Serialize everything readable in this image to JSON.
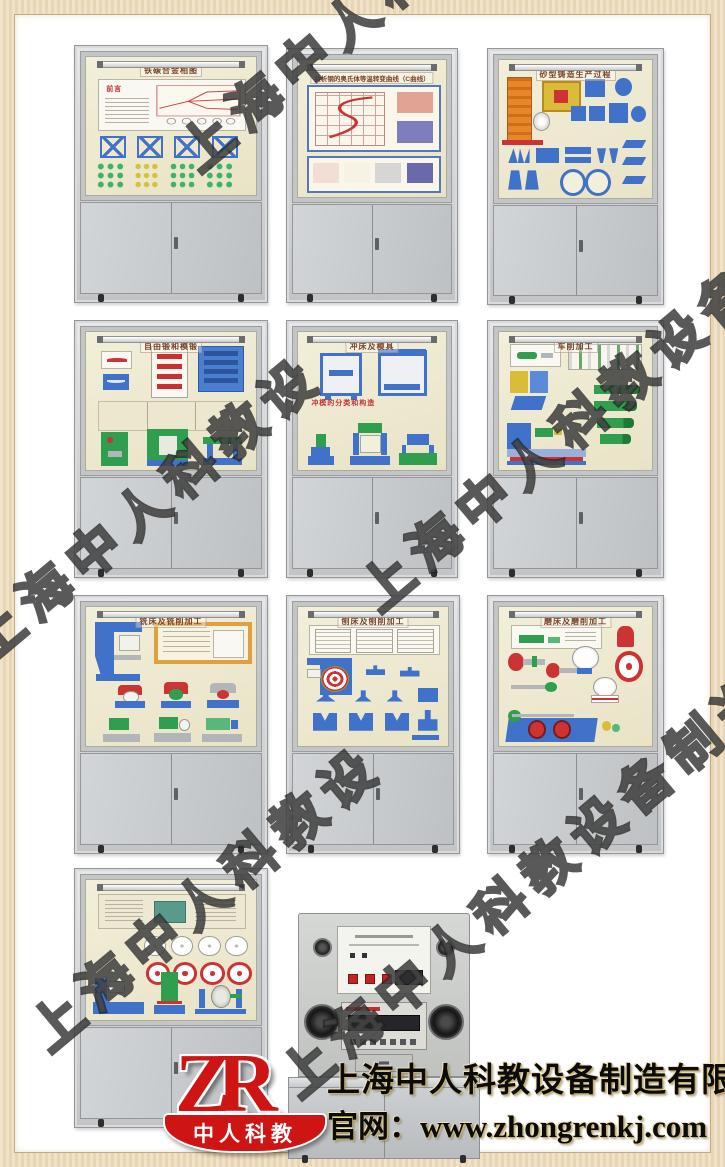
{
  "page": {
    "frame_color": "#e9d8b8",
    "background": "#ffffff",
    "description_colors": {
      "cabinet_gray": "#c6c9cc",
      "backboard_cream": "#efead2",
      "model_blue": "#3f72c8",
      "model_green": "#2f9e4f",
      "model_yellow": "#d9bc3a",
      "model_orange": "#e8872a",
      "model_red": "#cc3333"
    }
  },
  "watermark": {
    "text": "上海中人科教设备制造有限公司"
  },
  "cabinets": [
    {
      "id": 1,
      "title": "铁碳合金相图",
      "label": "前言"
    },
    {
      "id": 2,
      "title": "共析钢的奥氏体等温转变曲线（C曲线）",
      "label": ""
    },
    {
      "id": 3,
      "title": "砂型铸造生产过程",
      "label": ""
    },
    {
      "id": 4,
      "title": "自由锻和模锻",
      "label": ""
    },
    {
      "id": 5,
      "title": "冲床及模具",
      "label": "冲模的分类和构造"
    },
    {
      "id": 6,
      "title": "车削加工",
      "label": ""
    },
    {
      "id": 7,
      "title": "铣床及铣削加工",
      "label": ""
    },
    {
      "id": 8,
      "title": "刨床及刨削加工",
      "label": ""
    },
    {
      "id": 9,
      "title": "磨床及磨削加工",
      "label": ""
    },
    {
      "id": 10,
      "title": "",
      "label": ""
    }
  ],
  "branding": {
    "logo_text": "ZR",
    "logo_caption": "中人科教",
    "company": "上海中人科教设备制造有限公司",
    "website": "官网：www.zhongrenkj.com",
    "logo_color": "#cf1414"
  }
}
